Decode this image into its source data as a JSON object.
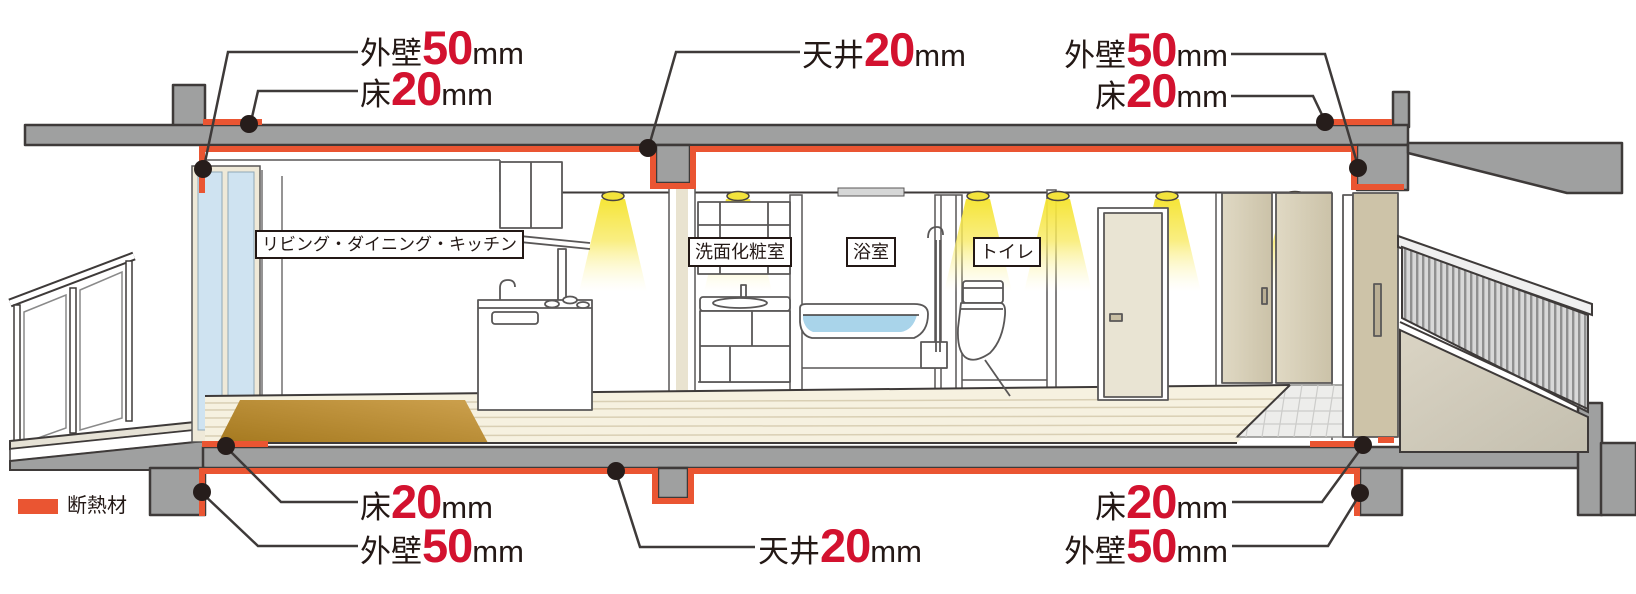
{
  "legend": {
    "label": "断熱材",
    "swatch_color": "#EA5532"
  },
  "rooms": {
    "ldk": "リビング・ダイニング・キッチン",
    "washroom": "洗面化粧室",
    "bathroom": "浴室",
    "toilet": "トイレ"
  },
  "callouts": {
    "top_left_wall": {
      "prefix": "外壁",
      "value": "50",
      "unit": "mm"
    },
    "top_left_floor": {
      "prefix": "床",
      "value": "20",
      "unit": "mm"
    },
    "top_center_ceiling": {
      "prefix": "天井",
      "value": "20",
      "unit": "mm"
    },
    "top_right_wall": {
      "prefix": "外壁",
      "value": "50",
      "unit": "mm"
    },
    "top_right_floor": {
      "prefix": "床",
      "value": "20",
      "unit": "mm"
    },
    "bottom_left_floor": {
      "prefix": "床",
      "value": "20",
      "unit": "mm"
    },
    "bottom_left_wall": {
      "prefix": "外壁",
      "value": "50",
      "unit": "mm"
    },
    "bottom_center_ceiling": {
      "prefix": "天井",
      "value": "20",
      "unit": "mm"
    },
    "bottom_right_floor": {
      "prefix": "床",
      "value": "20",
      "unit": "mm"
    },
    "bottom_right_wall": {
      "prefix": "外壁",
      "value": "50",
      "unit": "mm"
    }
  },
  "colors": {
    "insulation_orange": "#EA5532",
    "callout_number_red": "#D3122F",
    "text_black": "#231815",
    "concrete_gray": "#9FA0A0",
    "outline_dark": "#3E3A39",
    "downlight_yellow": "#F6E83F",
    "bath_water_blue": "#A9D4EA",
    "window_glass_blue": "#CFE3F1",
    "wood_rug_brown": "#B8893A"
  }
}
